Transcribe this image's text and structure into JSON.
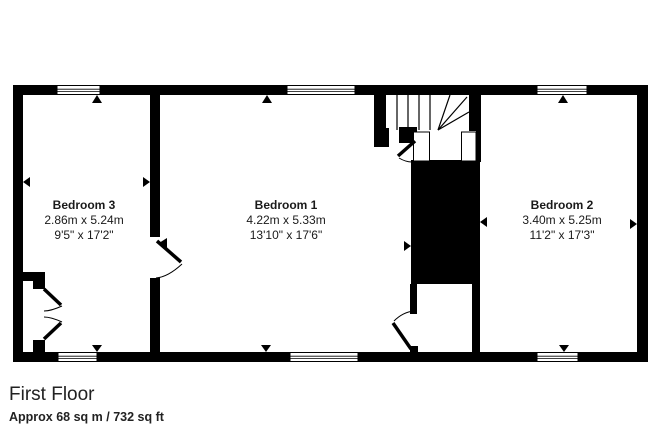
{
  "colors": {
    "wall": "#000000",
    "background": "#ffffff",
    "text": "#1a1a1a"
  },
  "rooms": [
    {
      "id": "bedroom-3",
      "name": "Bedroom 3",
      "metric": "2.86m x 5.24m",
      "imperial": "9'5\" x 17'2\""
    },
    {
      "id": "bedroom-1",
      "name": "Bedroom 1",
      "metric": "4.22m x 5.33m",
      "imperial": "13'10\" x 17'6\""
    },
    {
      "id": "bedroom-2",
      "name": "Bedroom 2",
      "metric": "3.40m x 5.25m",
      "imperial": "11'2\" x 17'3\""
    }
  ],
  "footer": {
    "title": "First Floor",
    "subtitle": "Approx 68 sq m / 732 sq ft"
  }
}
